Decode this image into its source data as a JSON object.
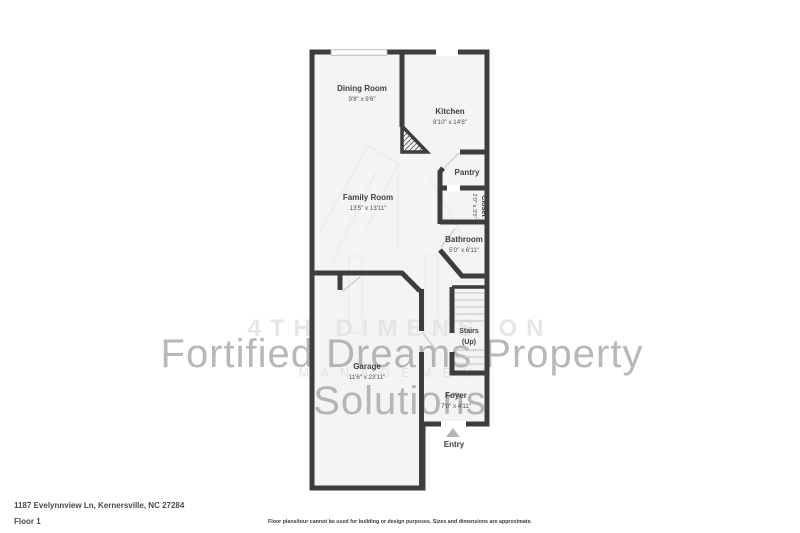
{
  "plan": {
    "rooms": {
      "dining": {
        "name": "Dining Room",
        "dims": "9'8\" x 9'6\""
      },
      "kitchen": {
        "name": "Kitchen",
        "dims": "8'10\" x 14'8\""
      },
      "pantry": {
        "name": "Pantry"
      },
      "closet": {
        "name": "Closet",
        "dims": "2'0\" x 3'5\""
      },
      "bathroom": {
        "name": "Bathroom",
        "dims": "5'0\" x 6'11\""
      },
      "family": {
        "name": "Family Room",
        "dims": "13'5\" x 13'11\""
      },
      "stairs": {
        "name": "Stairs",
        "sub": "(Up)"
      },
      "garage": {
        "name": "Garage",
        "dims": "11'6\" x 23'11\""
      },
      "foyer": {
        "name": "Foyer",
        "dims": "7'0\" x 4'11\""
      },
      "entry": {
        "name": "Entry"
      }
    },
    "colors": {
      "wall": "#3d3d3d",
      "floor": "#f4f4f4",
      "entry_arrow": "#b5b5b5"
    }
  },
  "watermark": {
    "back_line1": "4TH DIMENSION",
    "back_line2": "MANAGEMENT",
    "front_line1": "Fortified Dreams Property",
    "front_line2": "Solutions"
  },
  "footer": {
    "address": "1187 Evelynnview Ln, Kernersville, NC 27284",
    "floor_label": "Floor 1",
    "disclaimer": "Floor plans/tour cannot be used for building or design purposes. Sizes and dimensions are approximate."
  }
}
